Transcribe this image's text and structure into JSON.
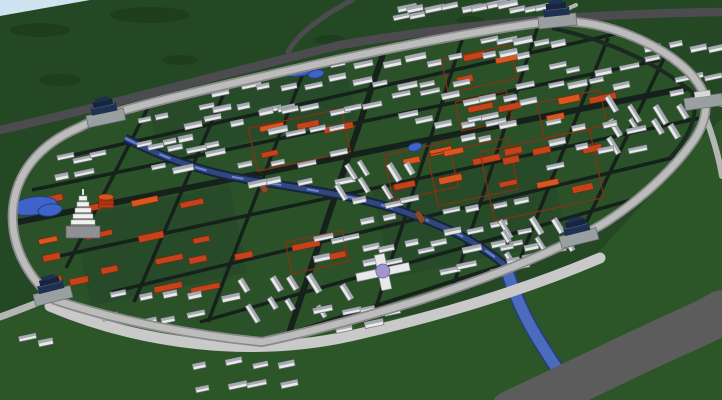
{
  "scene": {
    "width": 722,
    "height": 400,
    "colors": {
      "terrainBase": "#254824",
      "terrainLow": "#2d5628",
      "city": "#2b5128",
      "sky": "#cfe4f0",
      "mottle": "#1d3c1d",
      "roadDark": "#4c4c50",
      "highway": "#5c5c5c",
      "roadLight": "#b5b5b5",
      "wallShadow": "#8a8a8a",
      "wallTop": "#bcbcbc",
      "apron": "#c9c9c9",
      "innerShadow": "#1b2a20",
      "street": "#15211a",
      "riverDark": "#17233f",
      "riverCore": "#31487e",
      "riverGlint": "#6b86d4",
      "outRiverEdge": "#2a4070",
      "outRiver": "#4b6cbe",
      "pond": "#3f63c8",
      "pondEdge": "#22407e",
      "houseFace": "#eaeaea",
      "houseRoof": "#a6aab2",
      "houseStroke": "#6f737b",
      "red": "#c5431b",
      "redLight": "#d9561f",
      "redDark": "#7a230c",
      "redWall": "#8a2f12",
      "gateBase": "#9aa0a2",
      "gateBaseEdge": "#6c7072",
      "gateRoof": "#1f3150",
      "gateRoofDark": "#16243c",
      "gateHi": "#4a6694",
      "pagodaWhite": "#f2f2f2",
      "pagodaLine": "#9c9c9c",
      "platform": "#8e9096",
      "towerBody": "#b03a14",
      "towerTop": "#d4561e",
      "towerDark": "#7c240c",
      "dome": "#a295cb",
      "domeEdge": "#6b5fa0",
      "white": "#e9e9ec",
      "bridge": "#8a4a28"
    },
    "skyPoly": "0,0 90,0 0,16",
    "lowlandPoly": "0,320 55,302 240,346 480,302 590,262 700,140 722,118 722,400 0,400",
    "wallPath": "M 55,300 C 26,276 10,244 13,208 C 16,176 36,146 78,128 C 88,123 96,119 104,116 C 150,102 220,86 300,68 C 380,50 470,32 545,22 C 580,19 612,26 645,42 C 672,55 693,72 702,90 C 709,104 706,122 694,140 C 676,166 646,196 606,222 C 588,233 570,242 548,252 C 512,268 470,284 420,300 C 380,312 320,330 262,342 C 200,336 120,322 55,300 Z",
    "innerShadowPath": "M 552,28 C 615,42 660,66 692,92 C 699,112 692,134 670,158",
    "apronPath": "M 50,306 C 140,344 250,358 350,336 C 430,318 520,292 600,258",
    "roads": [
      {
        "name": "north-road",
        "path": "M 0,130 C 90,110 230,72 340,45 C 440,28 560,14 722,12",
        "w": 8.5,
        "c": "roadDark"
      },
      {
        "name": "north-road-branch",
        "path": "M 352,0 C 330,12 300,30 288,52",
        "w": 5,
        "c": "roadDark"
      },
      {
        "name": "east-gate-road",
        "path": "M 700,99 L 722,104",
        "w": 6,
        "c": "roadLight"
      },
      {
        "name": "east-outer-road",
        "path": "M 706,118 C 714,140 719,158 722,176",
        "w": 6,
        "c": "roadLight"
      },
      {
        "name": "west-gate-road",
        "path": "M 50,298 C 32,305 14,312 0,317",
        "w": 7,
        "c": "roadLight"
      },
      {
        "name": "top-gate-stub",
        "path": "M 556,18 C 562,12 568,8 576,5",
        "w": 4,
        "c": "roadLight"
      }
    ],
    "highway": {
      "name": "highway",
      "path": "M 512,412 C 560,390 620,360 660,342 C 690,328 710,320 722,312",
      "w": 44
    },
    "outRiverPath": "M 504,260 C 512,290 525,320 545,350 C 560,375 575,392 588,406",
    "riverPath": "M 125,138 C 160,156 200,172 250,180 C 310,190 360,196 410,214 C 450,228 480,244 506,266",
    "ponds": [
      [
        34,
        206,
        23,
        9,
        -8
      ],
      [
        50,
        210,
        12,
        6,
        -8
      ],
      [
        300,
        70,
        16,
        6,
        -10
      ],
      [
        316,
        74,
        8,
        4,
        -10
      ],
      [
        415,
        147,
        7,
        4,
        -14
      ]
    ],
    "streets": [
      [
        60,
        158,
        615,
        34,
        3.5
      ],
      [
        32,
        190,
        660,
        60,
        3.5
      ],
      [
        18,
        222,
        686,
        88,
        6
      ],
      [
        50,
        258,
        700,
        118,
        3.5
      ],
      [
        112,
        292,
        680,
        156,
        3.5
      ],
      [
        200,
        322,
        645,
        196,
        3.5
      ],
      [
        268,
        340,
        575,
        242,
        3.5
      ],
      [
        152,
        100,
        66,
        268,
        3.5
      ],
      [
        228,
        84,
        134,
        302,
        3.5
      ],
      [
        305,
        68,
        208,
        322,
        3.5
      ],
      [
        383,
        54,
        288,
        336,
        6
      ],
      [
        462,
        40,
        370,
        326,
        3.5
      ],
      [
        538,
        26,
        448,
        302,
        3.5
      ],
      [
        608,
        38,
        515,
        272,
        3.5
      ],
      [
        665,
        56,
        576,
        244,
        3.5
      ]
    ],
    "compounds": [
      [
        28,
        196,
        185,
        85,
        -12,
        9,
        0
      ],
      [
        150,
        248,
        105,
        52,
        -12,
        5,
        0
      ],
      [
        252,
        118,
        95,
        44,
        -12,
        4,
        1
      ],
      [
        388,
        148,
        66,
        46,
        -12,
        3,
        1
      ],
      [
        432,
        146,
        82,
        52,
        -12,
        4,
        1
      ],
      [
        444,
        52,
        70,
        34,
        -12,
        3,
        1
      ],
      [
        540,
        96,
        64,
        36,
        -12,
        3,
        1
      ],
      [
        486,
        140,
        112,
        70,
        -12,
        6,
        1
      ],
      [
        288,
        236,
        58,
        32,
        -12,
        2,
        1
      ],
      [
        22,
        262,
        92,
        30,
        -12,
        3,
        0
      ],
      [
        458,
        96,
        52,
        30,
        -12,
        2,
        1
      ]
    ],
    "clusters": [
      [
        128,
        112,
        115,
        42,
        9,
        -12
      ],
      [
        185,
        82,
        130,
        36,
        11,
        -12
      ],
      [
        322,
        52,
        140,
        40,
        12,
        -12
      ],
      [
        470,
        34,
        95,
        30,
        8,
        -12
      ],
      [
        255,
        100,
        125,
        40,
        10,
        -12
      ],
      [
        385,
        88,
        130,
        44,
        11,
        -12
      ],
      [
        512,
        62,
        118,
        44,
        11,
        -12
      ],
      [
        606,
        92,
        84,
        58,
        9,
        58
      ],
      [
        540,
        118,
        100,
        58,
        9,
        -12
      ],
      [
        455,
        115,
        60,
        30,
        5,
        -12
      ],
      [
        232,
        148,
        115,
        48,
        8,
        -12
      ],
      [
        335,
        152,
        90,
        42,
        7,
        58
      ],
      [
        428,
        196,
        105,
        46,
        8,
        -12
      ],
      [
        498,
        210,
        80,
        48,
        7,
        58
      ],
      [
        142,
        140,
        78,
        38,
        6,
        -12
      ],
      [
        46,
        148,
        58,
        34,
        5,
        -12
      ],
      [
        348,
        196,
        70,
        34,
        5,
        -12
      ],
      [
        96,
        288,
        138,
        44,
        9,
        -12
      ],
      [
        238,
        268,
        115,
        48,
        9,
        58
      ],
      [
        305,
        298,
        95,
        40,
        7,
        -12
      ],
      [
        352,
        238,
        80,
        38,
        6,
        -12
      ],
      [
        422,
        238,
        108,
        44,
        8,
        -12
      ],
      [
        302,
        232,
        56,
        30,
        4,
        -12
      ],
      [
        492,
        238,
        70,
        30,
        5,
        -12
      ],
      [
        388,
        2,
        96,
        20,
        8,
        -12
      ],
      [
        482,
        0,
        62,
        14,
        5,
        -12
      ],
      [
        640,
        40,
        76,
        28,
        5,
        -12
      ],
      [
        664,
        72,
        54,
        24,
        4,
        -12
      ],
      [
        188,
        352,
        102,
        46,
        8,
        -12
      ],
      [
        8,
        332,
        38,
        20,
        2,
        -12
      ]
    ],
    "gates": [
      [
        52,
        292,
        -14,
        "roofed"
      ],
      [
        105,
        114,
        -12,
        "roofed"
      ],
      [
        557,
        17,
        -6,
        "roofed"
      ],
      [
        578,
        234,
        -14,
        "roofed"
      ],
      [
        703,
        98,
        -8,
        "plain"
      ]
    ],
    "mottles": [
      [
        60,
        80,
        20,
        6
      ],
      [
        180,
        60,
        18,
        5
      ],
      [
        330,
        40,
        16,
        5
      ],
      [
        470,
        20,
        14,
        4
      ],
      [
        150,
        15,
        40,
        8
      ],
      [
        40,
        30,
        30,
        7
      ]
    ],
    "innerPatches": [
      [
        150,
        60,
        200,
        80
      ],
      [
        380,
        170,
        180,
        90
      ],
      [
        80,
        200,
        160,
        90
      ]
    ],
    "bridges": [
      [
        263,
        187,
        55
      ],
      [
        420,
        217,
        55
      ]
    ],
    "landmarks": {
      "pagoda": {
        "x": 83,
        "y": 226,
        "tiers": 5
      },
      "drumTower": {
        "x": 106,
        "y": 197
      },
      "domeBuilding": {
        "x": 383,
        "y": 272
      }
    }
  }
}
